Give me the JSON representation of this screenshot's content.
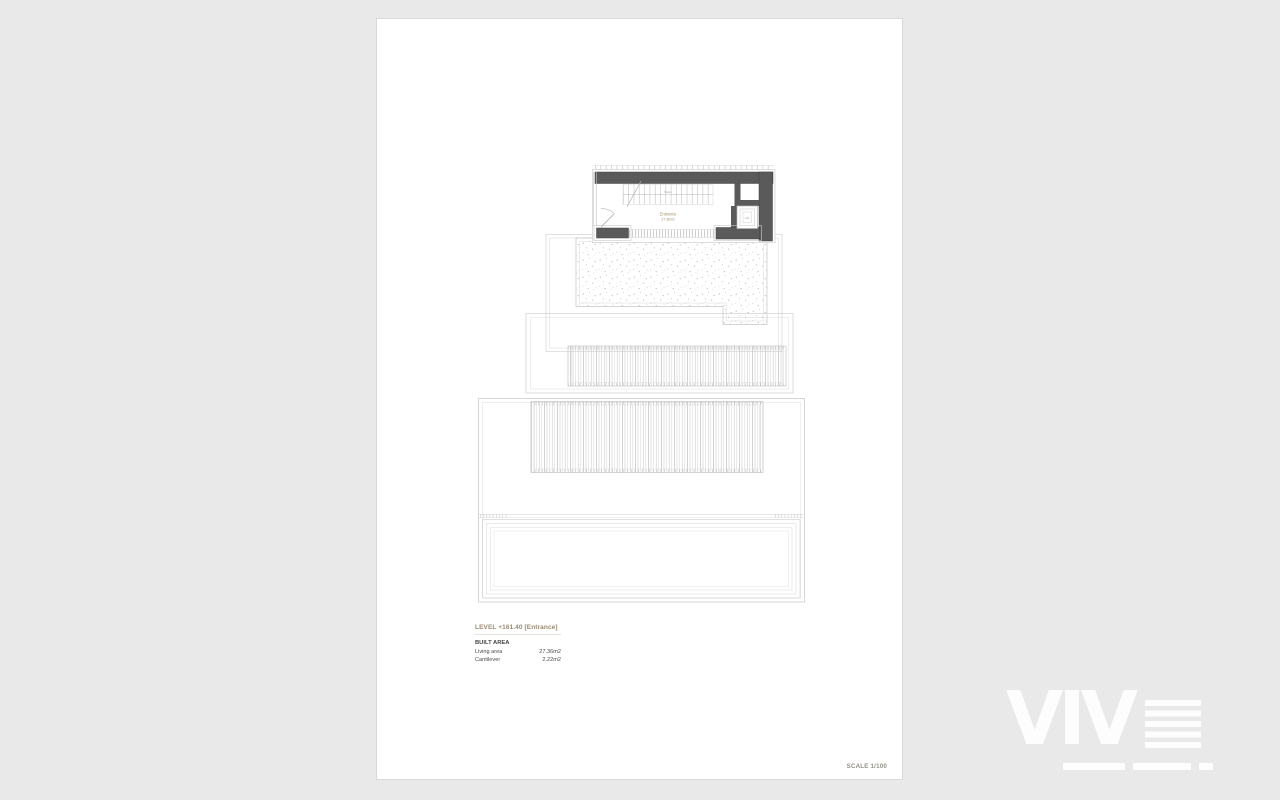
{
  "window": {
    "background_color": "#e9e9e9"
  },
  "sheet": {
    "title_block": {
      "level_title": "LEVEL +161.40 [Entrance]",
      "built_area_heading": "BUILT AREA",
      "areas": [
        {
          "label": "Living area",
          "value": "27.36m2"
        },
        {
          "label": "Cantilever",
          "value": "2.22m2"
        }
      ]
    },
    "scale_label": "SCALE 1/100"
  },
  "plan": {
    "room_label": "Entrance",
    "room_area_label": "27.36m2",
    "stairs_label": "Stairs",
    "lift_label": "Lift",
    "colors": {
      "wall": "#5a5a5a",
      "line": "#c9c9c9",
      "accent_text": "#a5906c"
    }
  },
  "watermark": {
    "text": "VIV"
  }
}
